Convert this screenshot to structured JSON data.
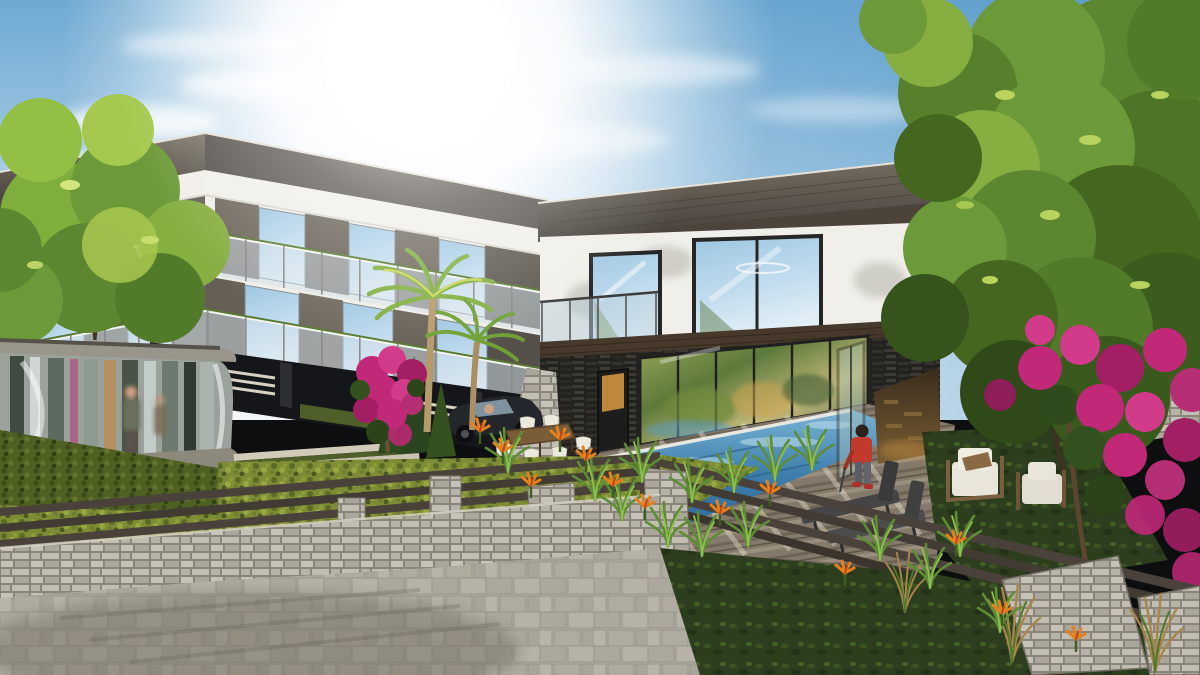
{
  "meta": {
    "title": "3D architectural exterior rendering",
    "description": "Sunlit photorealistic render: a 3-storey modern apartment block (left) and a 2-storey flat-roof villa (right) with swimming pool, timber deck, stone gabion walls with rail fences, paver patio, palm trees, large green trees and magenta bougainvillea gardens",
    "visible_text": "none",
    "width_px": 1200,
    "height_px": 675
  },
  "scene": {
    "objects": [
      {
        "name": "sun",
        "label": "bright sun glare upper left-center"
      },
      {
        "name": "sky",
        "label": "blue sky with wispy clouds"
      },
      {
        "name": "apartment-building-left",
        "label": "white 3-storey block, wood cladding, glass balconies"
      },
      {
        "name": "villa-right",
        "label": "white villa, dark flat roof, picture windows"
      },
      {
        "name": "glass-pavilion",
        "label": "curved glass entrance pavilion, left foreground"
      },
      {
        "name": "swimming-pool",
        "label": "blue rectangular pool"
      },
      {
        "name": "wood-deck",
        "label": "timber pool deck"
      },
      {
        "name": "child-figure",
        "label": "child in red jacket on deck"
      },
      {
        "name": "sun-loungers",
        "label": "two dark chaise lounges"
      },
      {
        "name": "garden-armchairs",
        "label": "two white-cushion wooden armchairs on lawn"
      },
      {
        "name": "outdoor-dining-set",
        "label": "wood table with white shell chairs"
      },
      {
        "name": "suv-car",
        "label": "dark parked car"
      },
      {
        "name": "palm-trees",
        "label": "two palms in front of left block"
      },
      {
        "name": "large-tree-right",
        "label": "big green tree over villa"
      },
      {
        "name": "tree-left",
        "label": "green tree over left block"
      },
      {
        "name": "bougainvillea",
        "label": "magenta flowering shrubs"
      },
      {
        "name": "bird-of-paradise",
        "label": "orange accent flowers"
      },
      {
        "name": "ornamental-grasses",
        "label": "green grass clumps at pool edge"
      },
      {
        "name": "reeds",
        "label": "tan reeds bottom right"
      },
      {
        "name": "gabion-walls",
        "label": "stacked stone retaining walls and pillars"
      },
      {
        "name": "rail-fence",
        "label": "dark horizontal rail fence"
      },
      {
        "name": "hedge",
        "label": "yellow-green hedges behind fences"
      },
      {
        "name": "vine-wall",
        "label": "green vine wall under pavilion"
      },
      {
        "name": "paver-patio",
        "label": "grey stone paver patio bottom left"
      },
      {
        "name": "driveway-strips",
        "label": "striped stone driveway"
      }
    ]
  },
  "palette": {
    "sky_top": "#6fa9d2",
    "sky_mid": "#a9cde6",
    "sky_horizon": "#eaf2f8",
    "sun": "#ffffff",
    "roof_fascia": "#55504a",
    "roof_fascia_light": "#7b7468",
    "wall_white": "#f0efe9",
    "wood_cladding": "#6e675c",
    "glass_sky": "#9cc6e2",
    "glass_sky_light": "#d7e8f3",
    "glass_warm": "#7c8c4a",
    "dark_plinth": "#141619",
    "wood_band": "#46392b",
    "stone_veneer": "#33322c",
    "door_glow": "#cf9440",
    "pool_light": "#7ab4d4",
    "pool_deep": "#2e6b99",
    "deck_wood": "#84796a",
    "stone_light": "#b7b3a8",
    "paver": "#b2aea3",
    "hedge": "#7e8c36",
    "lawn": "#2c3e1e",
    "grass": "#5e8d35",
    "tree_green": "#5d8631",
    "tree_light": "#a8c84f",
    "branch": "#3f3222",
    "bougainvillea": "#c12878",
    "bird_of_paradise": "#e5801f",
    "rail": "#4a423a",
    "pillar_stone": "#c6c2b7",
    "car": "#23262b",
    "chair_cushion": "#e9e5da",
    "lounger": "#454545",
    "child_jacket": "#c23a2c",
    "palm": "#7fae3c",
    "palm_trunk": "#b59a6a",
    "pavilion_band": "#9a958a"
  }
}
